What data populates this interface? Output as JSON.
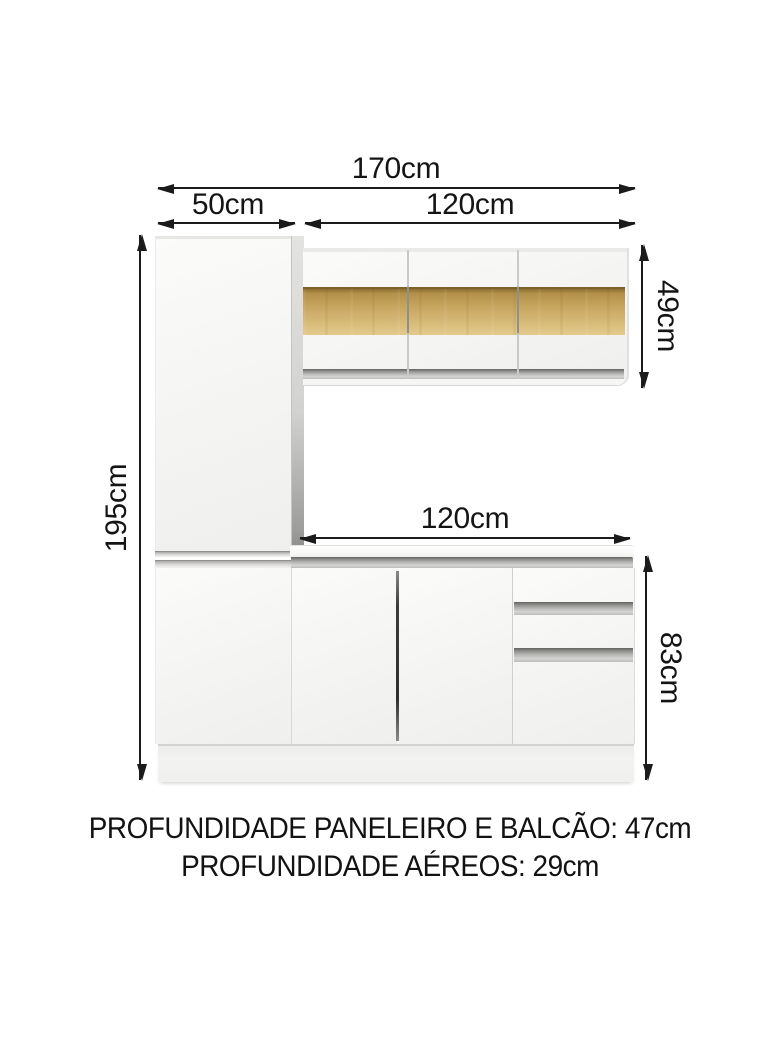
{
  "diagram": {
    "title_context": "kitchen cabinet set dimension diagram",
    "dims": {
      "total_width": "170cm",
      "left_cabinet_width": "50cm",
      "upper_cabinets_width": "120cm",
      "counter_width": "120cm",
      "total_height": "195cm",
      "upper_cabinets_height": "49cm",
      "counter_height": "83cm"
    },
    "footer": {
      "line1": "PROFUNDIDADE PANELEIRO E BALCÃO: 47cm",
      "line2": "PROFUNDIDADE AÉREOS: 29cm"
    },
    "colors": {
      "background": "#ffffff",
      "dimension_lines": "#1b1b1b",
      "cabinet_face": "#f4f4f2",
      "cabinet_side_panel": "#d6d6d4",
      "metal_handle_strip": "#a9a9a7",
      "amber_glass_strip": "#c6a55e",
      "door_gap_shadow": "#3c3c3a"
    }
  }
}
